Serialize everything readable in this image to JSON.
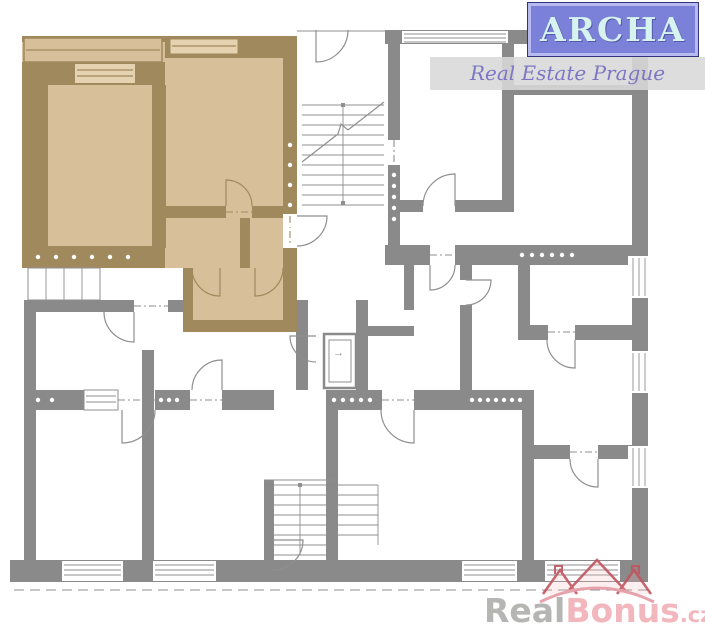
{
  "logo": {
    "title": "ARCHA",
    "subtitle": "Real Estate Prague"
  },
  "watermark": {
    "part1": "Real",
    "part2": "Bonus",
    "part3": ".cz"
  },
  "icons": {
    "elevator_arrow": "→"
  },
  "colors": {
    "wall": "#8a8a8a",
    "line": "#8f8f8f",
    "tan_fill": "#d7bf99",
    "tan_fill_light": "#e4d2b0",
    "tan_wall": "#a1895e",
    "band": "#d8d8d8",
    "logo_box": "#7b80d8",
    "logo_border": "#b6baee",
    "logo_text": "#d6f3ef",
    "logo_script": "#7d76c4",
    "wm_gray": "#b5b5b3",
    "wm_pink": "#f2b6bd",
    "roof": "#c25560",
    "roof_light": "#e59aa4"
  }
}
